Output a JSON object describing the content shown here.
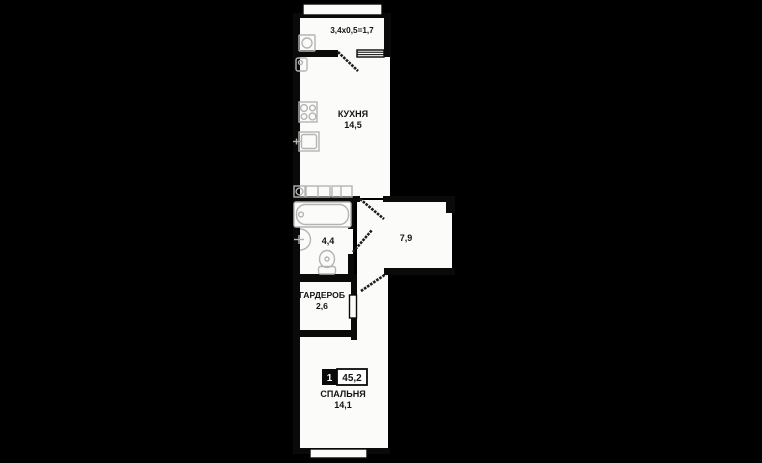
{
  "plan": {
    "type": "apartment-floor-plan",
    "unit_badge": {
      "number": "1",
      "total_area": "45,2"
    },
    "rooms": {
      "balcony": {
        "dims_label": "3,4х0,5=1,7"
      },
      "kitchen": {
        "name": "КУХНЯ",
        "area": "14,5"
      },
      "bathroom": {
        "area": "4,4"
      },
      "hallway": {
        "area": "7,9"
      },
      "wardrobe": {
        "name": "ГАРДЕРОБ",
        "area": "2,6"
      },
      "bedroom": {
        "name": "СПАЛЬНЯ",
        "area": "14,1"
      }
    },
    "colors": {
      "background": "#000000",
      "floor": "#fbfbf9",
      "wall": "#0a0a0a",
      "fixture": "#b4b4b2",
      "text": "#141414",
      "badge_bg": "#0a0a0a",
      "badge_text": "#ffffff"
    }
  }
}
